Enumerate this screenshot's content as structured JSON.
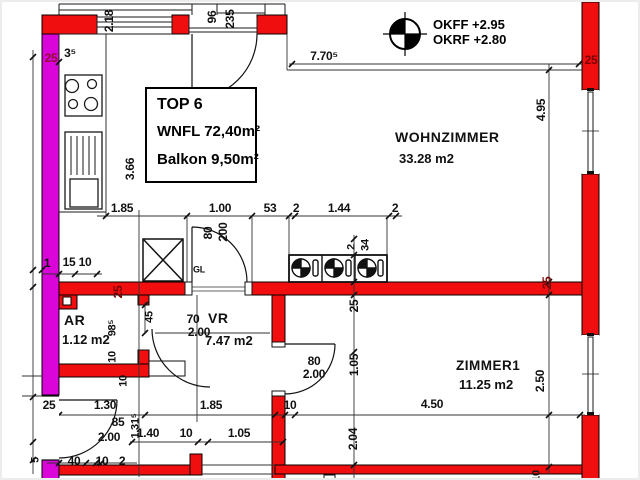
{
  "colors": {
    "wall_red": "#f10e0e",
    "party_wall_magenta": "#d905d9",
    "line_black": "#1a1a1a",
    "dim_dark_red": "#7a0000",
    "background": "#ffffff"
  },
  "info_box": {
    "title": "TOP 6",
    "line2": "WNFL 72,40m²",
    "line3": "Balkon 9,50m²"
  },
  "levels": {
    "line1": "OKFF +2.95",
    "line2": "OKRF +2.80"
  },
  "rooms": [
    {
      "name": "WOHNZIMMER",
      "area": "33.28 m2"
    },
    {
      "name": "ZIMMER1",
      "area": "11.25 m2"
    },
    {
      "name": "VR",
      "area": "7.47 m2"
    },
    {
      "name": "AR",
      "area": "1.12 m2"
    }
  ],
  "annotations": [
    {
      "t": "1.85",
      "x": 120,
      "y": 206
    },
    {
      "t": "1.00",
      "x": 218,
      "y": 206
    },
    {
      "t": "53",
      "x": 268,
      "y": 206
    },
    {
      "t": "2",
      "x": 294,
      "y": 206
    },
    {
      "t": "1.44",
      "x": 337,
      "y": 206
    },
    {
      "t": "2",
      "x": 393,
      "y": 206
    },
    {
      "t": "7.70⁵",
      "x": 322,
      "y": 54
    },
    {
      "t": "1.30",
      "x": 103,
      "y": 403
    },
    {
      "t": "1.85",
      "x": 209,
      "y": 403
    },
    {
      "t": "10",
      "x": 288,
      "y": 403
    },
    {
      "t": "4.50",
      "x": 430,
      "y": 402
    },
    {
      "t": "1.40",
      "x": 146,
      "y": 431
    },
    {
      "t": "10",
      "x": 184,
      "y": 431
    },
    {
      "t": "1.05",
      "x": 237,
      "y": 431
    },
    {
      "t": "40",
      "x": 72,
      "y": 459
    },
    {
      "t": "10",
      "x": 100,
      "y": 459
    },
    {
      "t": "2",
      "x": 120,
      "y": 459
    },
    {
      "t": "15",
      "x": 67,
      "y": 260
    },
    {
      "t": "10",
      "x": 83,
      "y": 260
    },
    {
      "t": "1",
      "x": 45,
      "y": 261
    },
    {
      "t": "25",
      "x": 49,
      "y": 56,
      "c": "#8f1030"
    },
    {
      "t": "25",
      "x": 589,
      "y": 58,
      "c": "#7a0000"
    },
    {
      "t": "25",
      "x": 47,
      "y": 403
    },
    {
      "t": "3⁵",
      "x": 68,
      "y": 51
    },
    {
      "t": "85",
      "x": 116,
      "y": 420
    },
    {
      "t": "2.00",
      "x": 107,
      "y": 435
    },
    {
      "t": "70",
      "x": 191,
      "y": 317
    },
    {
      "t": "2.00",
      "x": 197,
      "y": 330
    },
    {
      "t": "80",
      "x": 312,
      "y": 359
    },
    {
      "t": "2.00",
      "x": 312,
      "y": 372
    },
    {
      "t": "GL",
      "x": 197,
      "y": 268,
      "s": 9
    },
    {
      "t": "2.18",
      "x": 107,
      "y": 19,
      "r": 1
    },
    {
      "t": "96",
      "x": 210,
      "y": 15,
      "r": 1
    },
    {
      "t": "235",
      "x": 228,
      "y": 17,
      "r": 1
    },
    {
      "t": "3.66",
      "x": 128,
      "y": 167,
      "r": 1
    },
    {
      "t": "4.95",
      "x": 539,
      "y": 108,
      "r": 1
    },
    {
      "t": "25",
      "x": 352,
      "y": 304,
      "r": 1
    },
    {
      "t": "1.05",
      "x": 352,
      "y": 363,
      "r": 1
    },
    {
      "t": "2.04",
      "x": 351,
      "y": 437,
      "r": 1
    },
    {
      "t": "2.50",
      "x": 538,
      "y": 379,
      "r": 1
    },
    {
      "t": "80",
      "x": 206,
      "y": 231,
      "r": 1
    },
    {
      "t": "200",
      "x": 221,
      "y": 230,
      "r": 1
    },
    {
      "t": "2",
      "x": 350,
      "y": 245,
      "r": 1,
      "s": 11
    },
    {
      "t": "34",
      "x": 364,
      "y": 243,
      "r": 1,
      "s": 11
    },
    {
      "t": "98⁵",
      "x": 111,
      "y": 326,
      "r": 1,
      "s": 11
    },
    {
      "t": "10",
      "x": 111,
      "y": 355,
      "r": 1,
      "s": 11
    },
    {
      "t": "45",
      "x": 148,
      "y": 315,
      "r": 1,
      "s": 11
    },
    {
      "t": "10",
      "x": 122,
      "y": 379,
      "r": 1,
      "s": 11
    },
    {
      "t": "1.31⁵",
      "x": 134,
      "y": 424,
      "r": 1,
      "s": 11
    },
    {
      "t": "5",
      "x": 34,
      "y": 458,
      "r": 1,
      "s": 11
    },
    {
      "t": "10",
      "x": 535,
      "y": 474,
      "r": 1,
      "s": 11
    },
    {
      "t": "25",
      "x": 116,
      "y": 290,
      "r": 1,
      "c": "#7a0000"
    },
    {
      "t": "25",
      "x": 545,
      "y": 281,
      "r": 1,
      "c": "#7a0000"
    }
  ]
}
